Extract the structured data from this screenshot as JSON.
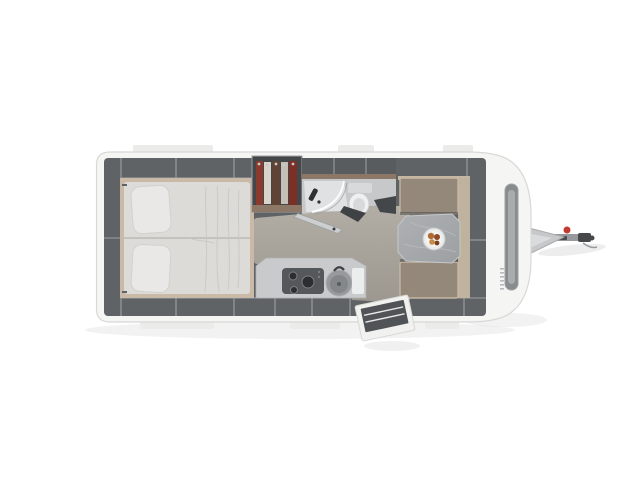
{
  "scene": {
    "subject": "top-down floor plan render of a single-axle travel caravan, drawbar pointing right",
    "zones": {
      "rear_bed": "double-bed-two-pillows",
      "wardrobe": "hanging-clothes-closet",
      "bathroom": "shower-and-toilet",
      "kitchen": "hob-sink-counter",
      "dinette": "two-benches-table-fruit-bowl",
      "entry": "open-door-with-step",
      "front": "front-window-and-drawbar-hitch"
    }
  },
  "colors": {
    "background": "#ffffff",
    "shadow": "#000000",
    "body": "#f5f5f4",
    "body_edge": "#d8d8d6",
    "body_tab": "#ebebea",
    "window_outer": "#898c8f",
    "window_inner": "#a9acaf",
    "drawbar": "#c6c8ca",
    "drawbar_light": "#d9dbdc",
    "drawbar_edge": "#a8aaac",
    "hitch_bar": "#97999c",
    "hitch_coupling": "#46484a",
    "hitch_red": "#c23b31",
    "interior": "#606366",
    "interior_dark": "#44474a",
    "divider": "#9ea0a2",
    "floor_light": "#b2ada5",
    "floor_dark": "#9c978f",
    "bed_frame": "#c9b9a6",
    "mattress": "#dcdbd8",
    "mattress_line": "#b5b3b0",
    "wrinkle": "#c9c8c5",
    "pillow": "#e9e8e6",
    "pillow_edge": "#d2d1ce",
    "wood_trim": "#8d7767",
    "clothes": [
      "#8a3b2c",
      "#d9d3c9",
      "#5f4435",
      "#c5bfb5",
      "#7c2f24"
    ],
    "hanger": "#c8cacc",
    "bath_top": "#595c5e",
    "bath_floor": "#c6c8ca",
    "shower_tray": "#dfe1e3",
    "shower_glass": "#ffffff",
    "shower_head": "#2e3032",
    "toilet": "#eef0f1",
    "toilet_tank": "#d7d9da",
    "toilet_edge": "#c9cbcc",
    "bath_door": "#cdced0",
    "bath_door_dark": "#3f4244",
    "counter": "#c9cacc",
    "counter_edge": "#aeb0b2",
    "hob": "#55585b",
    "burner": "#2c2e30",
    "burner_rim": "#7c7e80",
    "sink": "#969a9d",
    "sink_inner": "#84878a",
    "sink_drain": "#5a5d5f",
    "faucet": "#3c3e40",
    "board": "#eceded",
    "seat": "#94887b",
    "seat_trim": "#c6b7a3",
    "seat_shadow": "#4a4d4f",
    "backrest_panel": "#bfb29f",
    "table_light": "#aeb1b4",
    "table_dark": "#9da0a3",
    "table_vein": "#c6c8ca",
    "bowl": "#ebebea",
    "bowl_inner": "#f4f4f3",
    "fruit_a": "#b06a33",
    "fruit_b": "#8f4a28",
    "fruit_c": "#c98b44",
    "fruit_d": "#774023",
    "door_frame": "#f1f1f0",
    "door_panel": "#515457",
    "door_stripe": "#e8e8e7",
    "brand": "#b7b9ba"
  }
}
